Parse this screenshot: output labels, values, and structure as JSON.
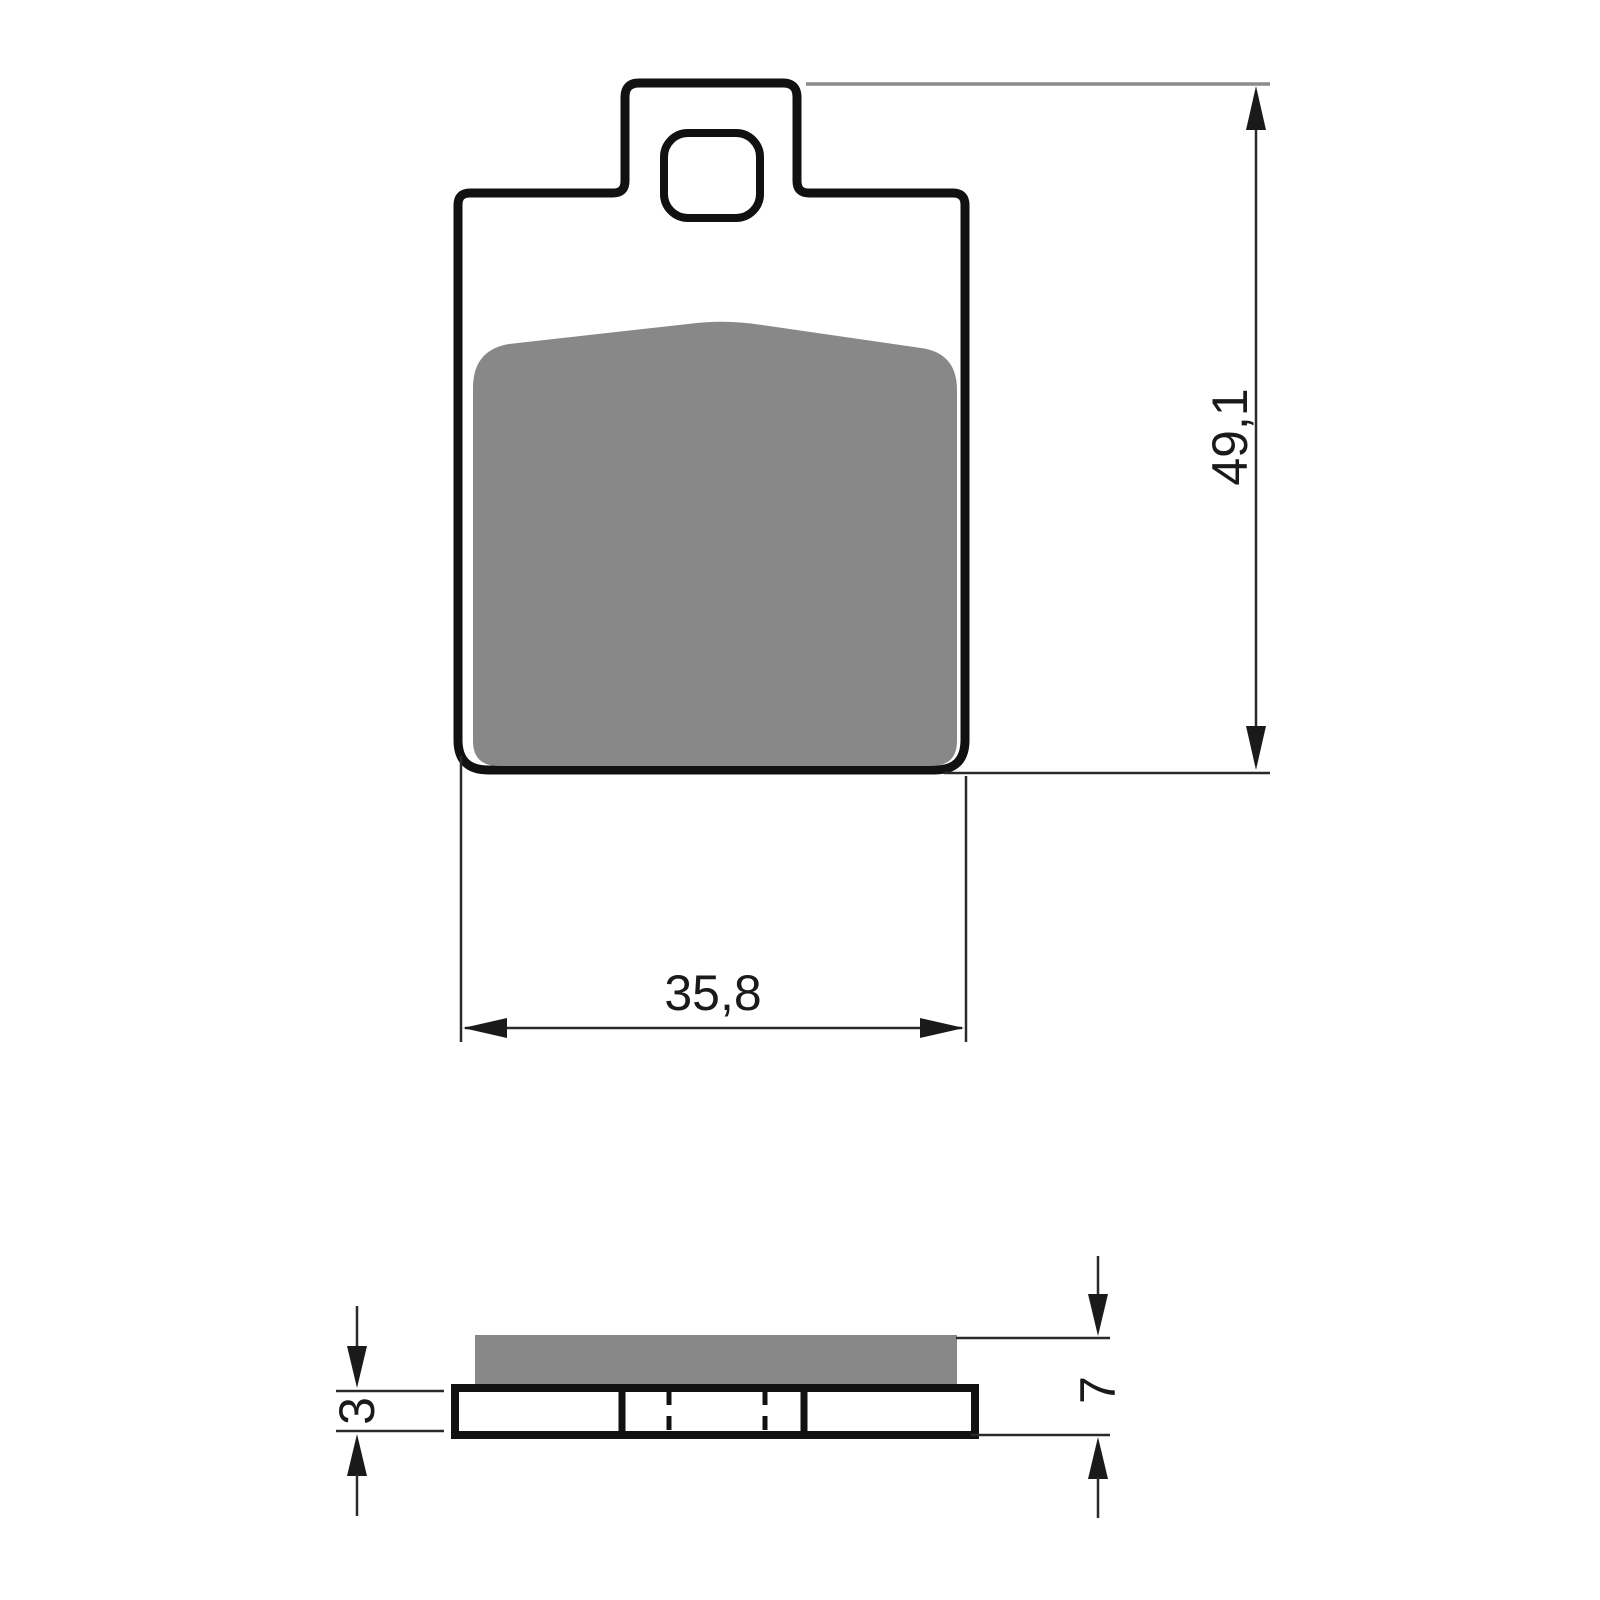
{
  "drawing": {
    "description": "Brake pad dimensional technical drawing, front view and side section view",
    "front_view": {
      "height_dimension_label": "49,1",
      "width_dimension_label": "35,8"
    },
    "side_view": {
      "backplate_thickness_label": "3",
      "total_thickness_label": "7"
    }
  },
  "colors": {
    "background": "#ffffff",
    "part_outline": "#111111",
    "friction_material_gray": "#888888",
    "dimension_line": "#2a2a2a",
    "extension_line_gray": "#8c8c8c",
    "text": "#1a1a1a"
  }
}
